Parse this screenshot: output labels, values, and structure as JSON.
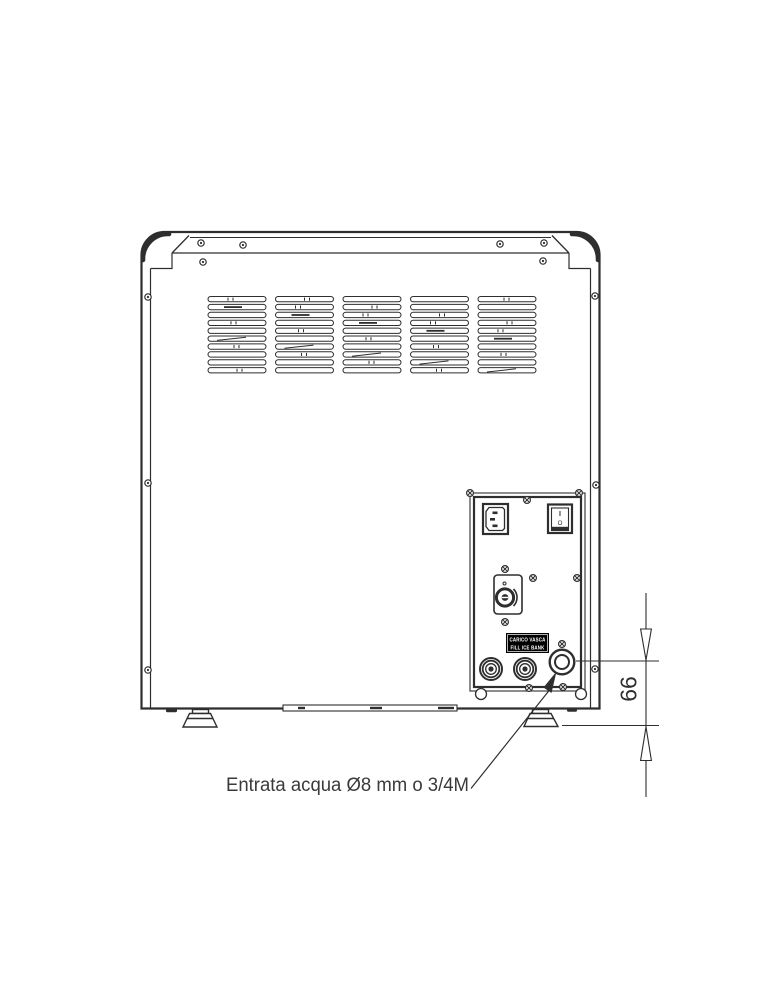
{
  "diagram": {
    "panel_label": {
      "line1": "CARICO VASCA",
      "line2": "FILL ICE BANK"
    },
    "power_switch": {
      "on": "I",
      "off": "O"
    },
    "annotations": {
      "water_inlet": "Entrata acqua Ø8 mm o 3/4M",
      "height_mm": "66"
    },
    "colors": {
      "line": "#2e2e2e",
      "label_bg": "#000000",
      "label_text": "#ffffff",
      "background": "#ffffff"
    }
  }
}
